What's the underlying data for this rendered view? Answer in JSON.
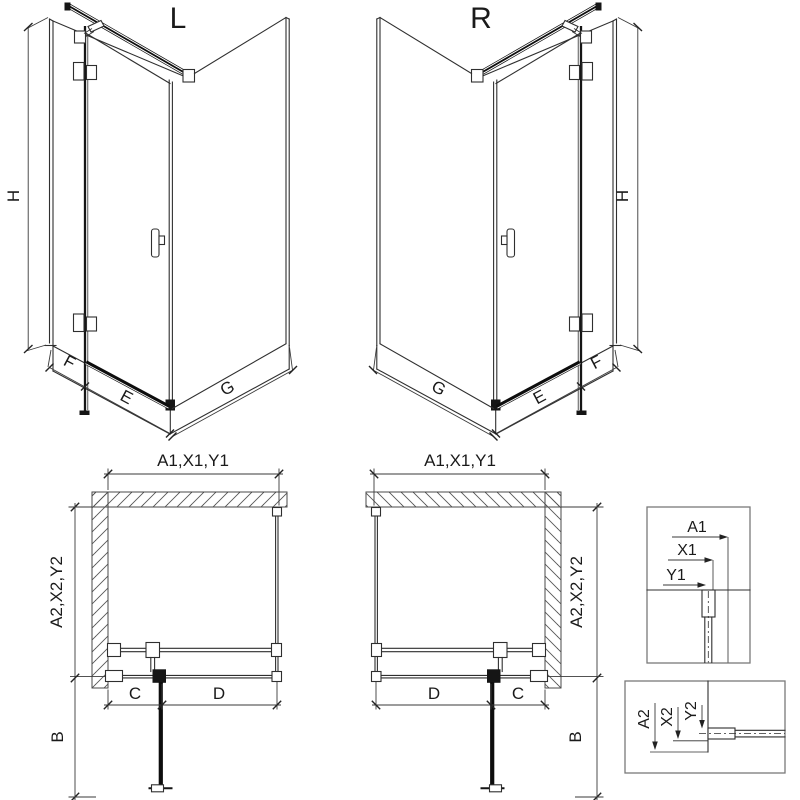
{
  "diagram_type": "shower-enclosure-technical-drawing",
  "colors": {
    "line": "#2f2f2f",
    "thick_line": "#0d0d0d",
    "hatch": "#555555",
    "detail_box_border": "#7a7a7a",
    "text": "#1a1a1a",
    "background": "#ffffff"
  },
  "iso_left": {
    "title": "L",
    "height": "H",
    "fixed": "F",
    "door": "E",
    "side": "G"
  },
  "iso_right": {
    "title": "R",
    "height": "H",
    "fixed": "F",
    "door": "E",
    "side": "G"
  },
  "plan_left": {
    "top_dim": "A1,X1,Y1",
    "side_dim": "A2,X2,Y2",
    "swing_dim": "B",
    "fixed_dim": "C",
    "door_dim": "D"
  },
  "plan_right": {
    "top_dim": "A1,X1,Y1",
    "side_dim": "A2,X2,Y2",
    "swing_dim": "B",
    "fixed_dim": "C",
    "door_dim": "D"
  },
  "detail_wall_profile": {
    "dims": [
      "A1",
      "X1",
      "Y1"
    ]
  },
  "detail_floor_profile": {
    "dims": [
      "A2",
      "X2",
      "Y2"
    ]
  }
}
